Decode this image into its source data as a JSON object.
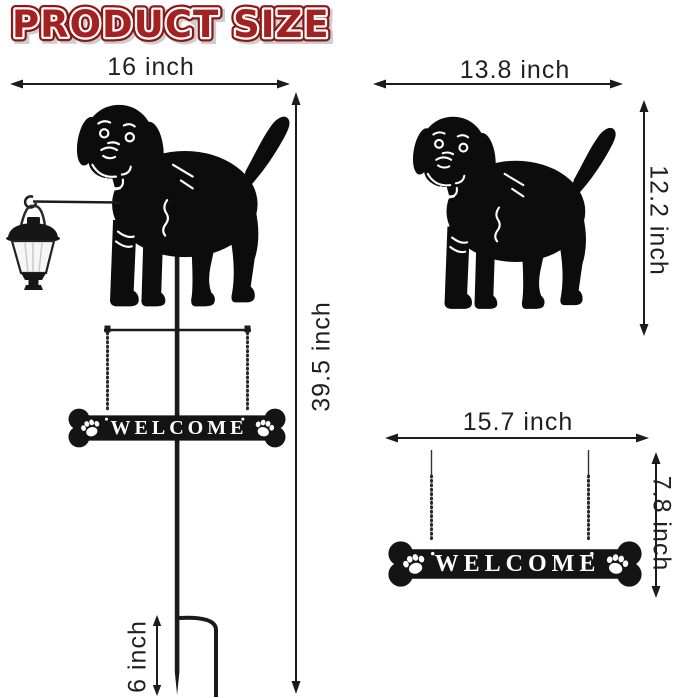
{
  "title": "PRODUCT SIZE",
  "colors": {
    "title_red": "#a32121",
    "title_outline_red": "#8d1616",
    "title_shadow": "#bdbdbd",
    "dimension_line": "#1c1c1c",
    "silhouette_black": "#0c0c0c",
    "sign_text_white": "#ffffff",
    "background": "#ffffff"
  },
  "figures": {
    "left": {
      "description": "full garden stake with lantern, dog and welcome sign",
      "width_label": "16 inch",
      "height_label": "39.5 inch",
      "stake_label": "6 inch",
      "sign_text": "WELCOME"
    },
    "top_right": {
      "description": "dog silhouette only",
      "width_label": "13.8 inch",
      "height_label": "12.2 inch"
    },
    "bottom_right": {
      "description": "hanging bone welcome sign only",
      "width_label": "15.7 inch",
      "height_label": "7.8 inch",
      "sign_text": "WELCOME"
    }
  },
  "icons": {
    "dog": "labrador-silhouette",
    "lantern": "solar-lantern",
    "sign": "bone-welcome-sign",
    "paw": "paw-print",
    "arrow": "dimension-arrow"
  }
}
